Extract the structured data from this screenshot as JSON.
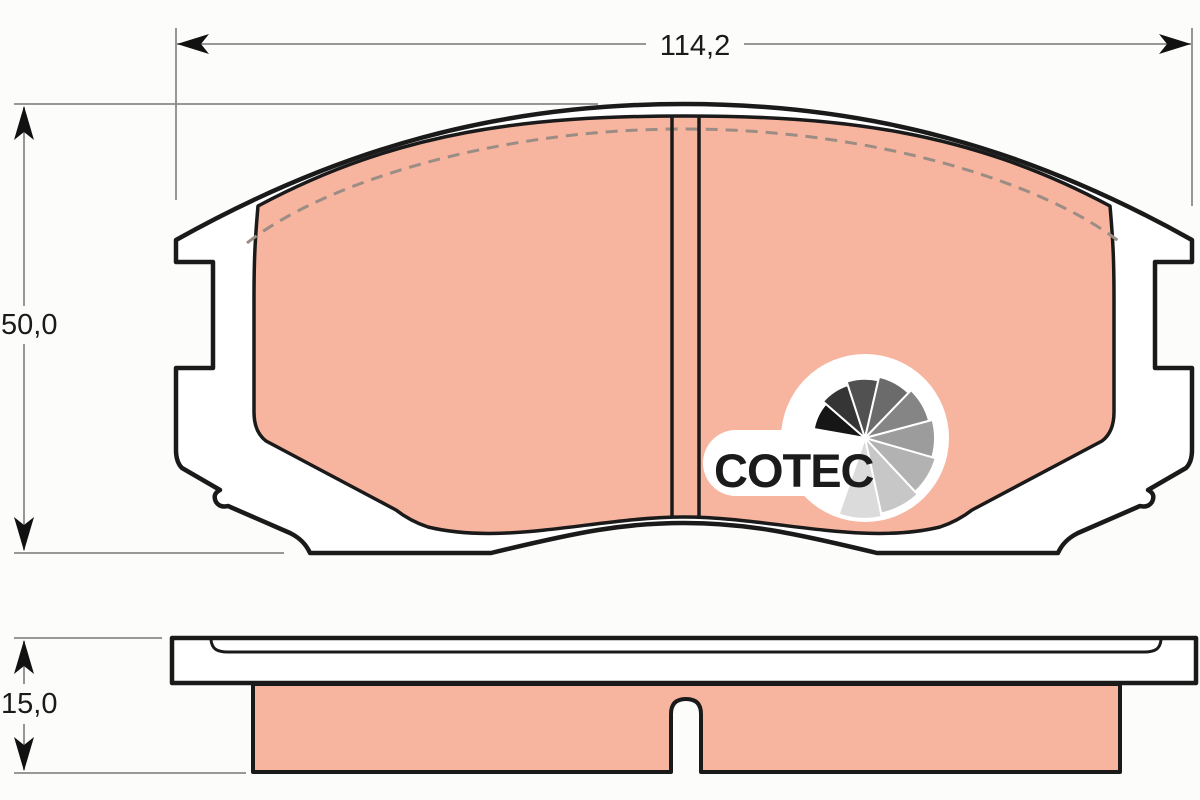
{
  "diagram": {
    "title": "brake-pad technical drawing (front view and side view)",
    "dimensions": {
      "width": {
        "value": "114,2"
      },
      "height": {
        "value": "50,0"
      },
      "thickness": {
        "value": "15,0"
      }
    },
    "logo": {
      "text": "COTEC",
      "text_color": "#1b1b1b",
      "fan_colors": [
        "#161616",
        "#353535",
        "#515151",
        "#6b6b6b",
        "#858585",
        "#9c9c9c",
        "#b2b2b2",
        "#c7c7c7",
        "#dbdbdb"
      ]
    },
    "colors": {
      "friction_material": "#f7b49e",
      "backing_plate": "#ffffff",
      "outline": "#1a1a1a",
      "dimension_line": "#8a8a8a",
      "chamfer_dash": "#9b8d85",
      "background": "#fcfcfa"
    }
  }
}
